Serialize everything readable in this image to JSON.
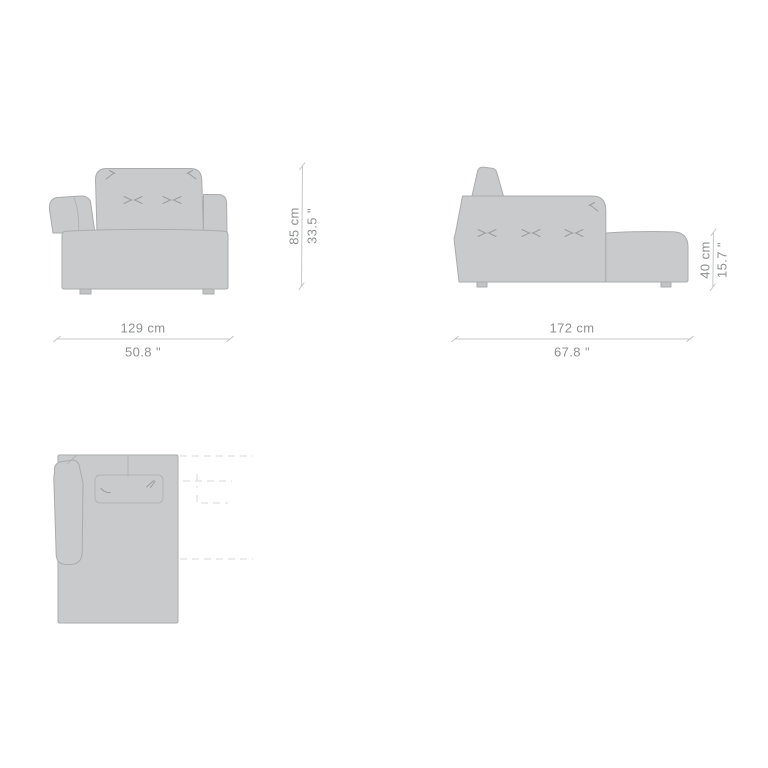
{
  "drawing": {
    "body_fill": "#c9cacb",
    "body_outline": "#aaacad",
    "stitch_color": "#9b9d9e",
    "dimension_line_color": "#c6c7c8",
    "dimension_text_color": "#8e9091",
    "ghost_outline_color": "#d9dadb",
    "background": "#ffffff"
  },
  "front_view": {
    "width_cm": "129 cm",
    "width_in": "50.8 \"",
    "height_cm": "85 cm",
    "height_in": "33.5 \""
  },
  "side_view": {
    "length_cm": "172 cm",
    "length_in": "67.8 \"",
    "seat_height_cm": "40 cm",
    "seat_height_in": "15.7 \""
  }
}
